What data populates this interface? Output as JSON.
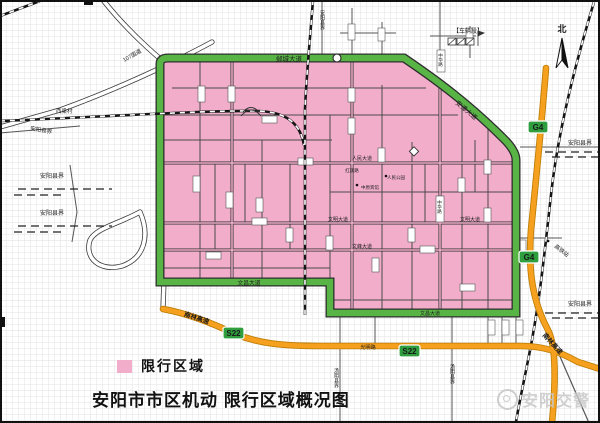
{
  "title": "安阳市市区机动 限行区域概况图",
  "legend": {
    "label": "限行区域"
  },
  "watermark": {
    "label": "安阳交警"
  },
  "compass": {
    "label": "北"
  },
  "badges": {
    "g4": "G4",
    "s22": "S22"
  },
  "road_labels": {
    "yecheng_avenue": "邺城大道",
    "anzhang_avenue": "安漳大道",
    "wenchang_avenue": "文昌大道",
    "renmin_avenue": "人民大道",
    "wenming_avenue": "文明大道",
    "wenfeng_avenue": "文峰大道",
    "hongqi_road": "红旗路",
    "zhonghua_road": "中华路",
    "guangming_road": "光明路",
    "nanlin_expressway": "南林高速",
    "national_road_107": "107国道"
  },
  "boundary_labels": {
    "anyang_county": "安阳县界",
    "tangyin_county": "汤阴县界"
  },
  "place_labels": {
    "xiliang_village": "西梁村",
    "depot": "【车辆段】",
    "hsr_station": "高铁站",
    "renmin_park": "人民公园",
    "zhongyuan_hotel": "中原宾馆"
  },
  "colors": {
    "restricted_zone_pink": "#f1adca",
    "ring_road_green": "#59b446",
    "expressway_orange": "#f5a01e",
    "badge_green": "#2f9e3f",
    "grid_gray": "#e3e3e3"
  }
}
